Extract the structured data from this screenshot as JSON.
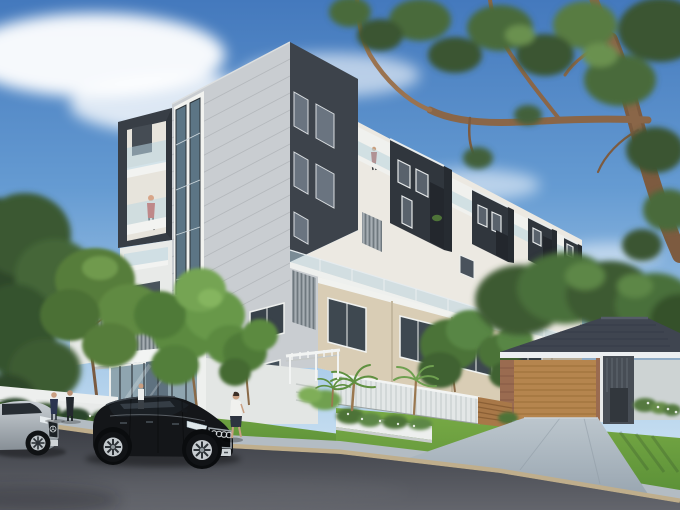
{
  "scene": {
    "alt": "Photorealistic architectural rendering: a modern 6-level apartment building in white, light grey and charcoal with glass balconies, seen from the street corner on a sunny day. A large eucalyptus tree overhangs from the top right, a black Audi sedan and a silver Mercedes are parked on the asphalt road in the foreground, pedestrians stand on the footpath, and a single-storey brick house with a timber garage door and dark tiled roof sits at the right beside landscaped gardens, palms and lawns.",
    "objects": [
      "blue sky with white clouds",
      "eucalyptus canopy and branches top right",
      "apartment building with charcoal rooftop units and glass balconies",
      "grey panel corner tower with charcoal balcony box",
      "glazed entrance lobby with louvre screen",
      "beige brick townhouse row with street trees",
      "single storey house with timber garage door",
      "white slat fence and timber fence panel",
      "gardens, palms, lawns and white planter walls",
      "black Audi sedan",
      "silver Mercedes sedan",
      "five pedestrians and two balcony figures",
      "asphalt road, kerb and concrete footpath and driveway"
    ]
  },
  "colors": {
    "sky_deep": "#4479bd",
    "cloud": "#ffffff",
    "facade_grey": "#c9cdd1",
    "facade_white": "#f0f1ee",
    "charcoal": "#3d434b",
    "charcoal_dark": "#30363d",
    "glass_blue": "#b7d3e0",
    "window_frame_dark": "#323a41",
    "brick_beige": "#d9cdb5",
    "timber": "#a87848",
    "garage_timber": "#b5854e",
    "roof_slate": "#3f4550",
    "grass_green": "#6aa23f",
    "foliage_dark": "#3a5431",
    "foliage_light": "#5c8a3f",
    "branch_brown": "#8a6648",
    "road_asphalt": "#4a4d54",
    "kerb_tan": "#bfae8c",
    "concrete": "#b3bcc3",
    "car_black": "#141619",
    "car_silver": "#b6bcc2",
    "accent_red": "#c23b30"
  }
}
